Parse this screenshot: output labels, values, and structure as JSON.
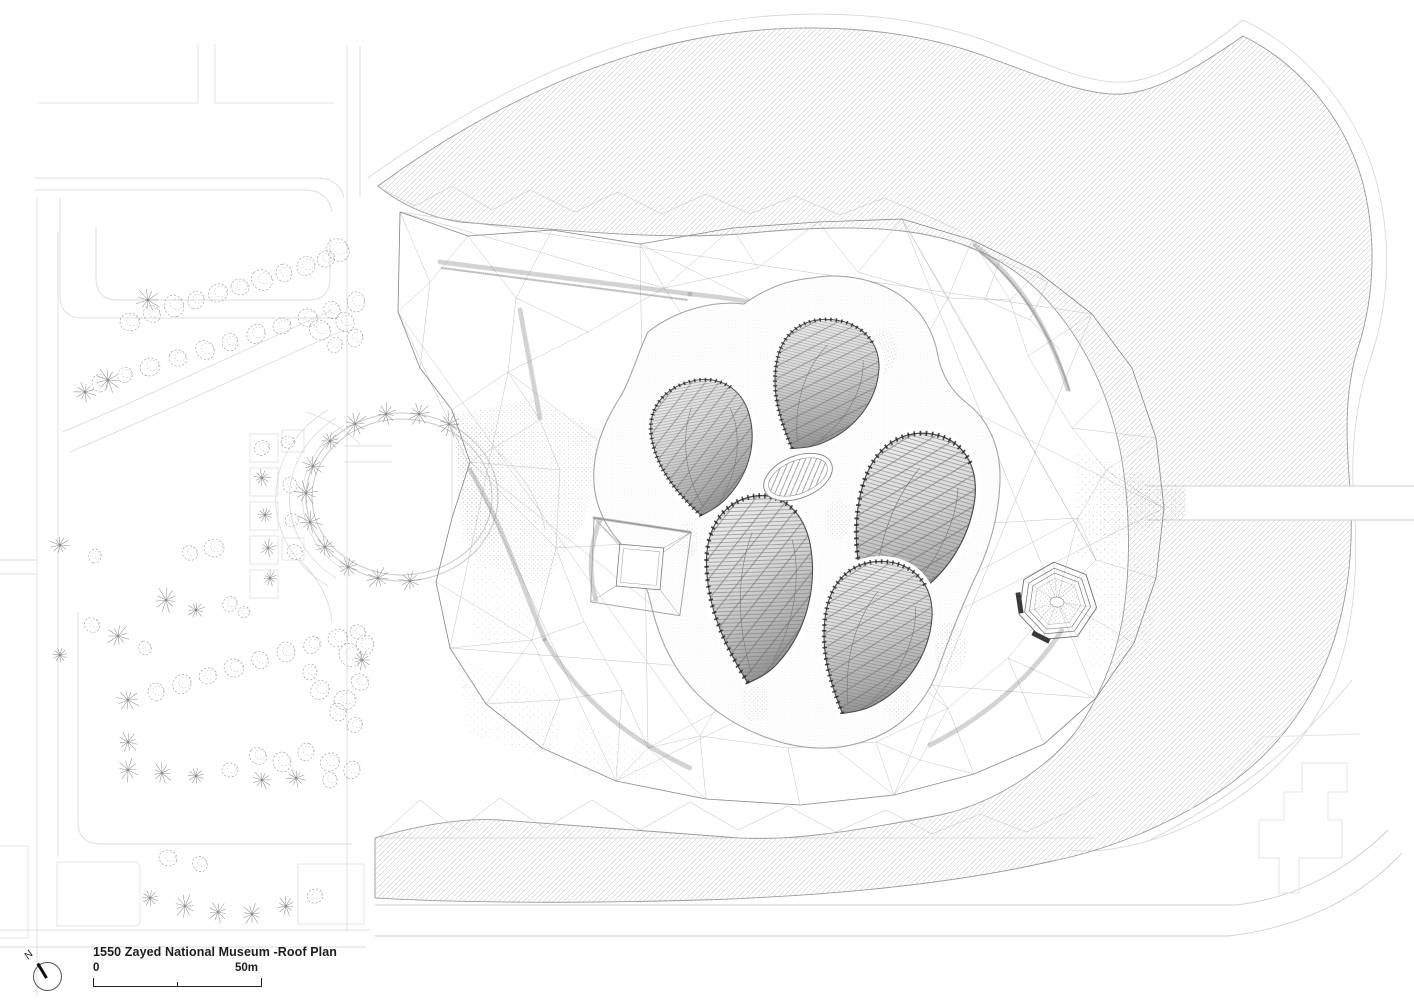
{
  "drawing": {
    "title": "1550 Zayed National Museum -Roof Plan",
    "north_label": "N",
    "scale_bar": {
      "start_label": "0",
      "end_label": "50m"
    }
  },
  "colors": {
    "paper": "#ffffff",
    "ink": "#1c1c1c",
    "road": "#dcdcdc",
    "block": "#e4e4e4",
    "dune-line": "#9a9a9a",
    "dune-offset": "#d4d4d4",
    "mesh": "#b6b6b6",
    "boundary": "#8d8d8d",
    "podium": "#8a8a8a",
    "petal-line": "#4a4a4a",
    "tick": "#1f1f1f",
    "stipple": "#808080",
    "tree": "#9b9b9b"
  }
}
